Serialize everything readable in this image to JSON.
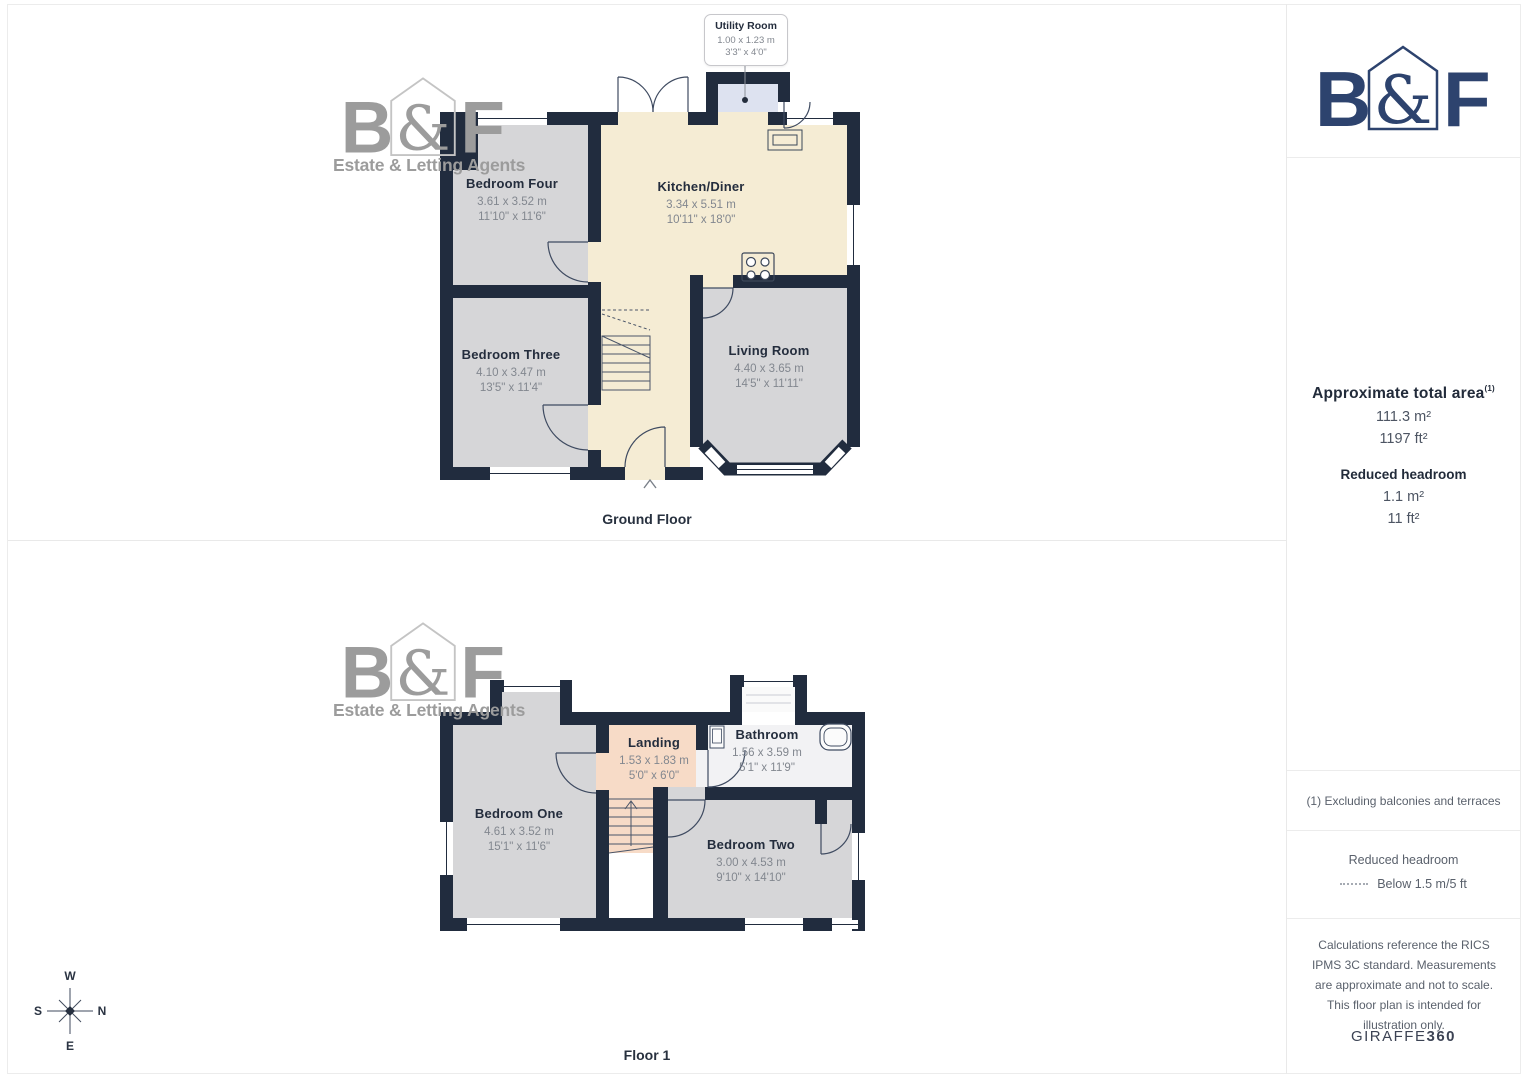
{
  "logo": {
    "letter_b": "B",
    "ampersand": "&",
    "letter_f": "F",
    "tagline": "Estate & Letting Agents",
    "navy": "#2d436e",
    "gray": "#9c9c9c"
  },
  "ground_floor": {
    "caption": "Ground Floor",
    "utility_callout": {
      "name": "Utility Room",
      "metric": "1.00 x 1.23 m",
      "imperial": "3'3\" x 4'0\""
    },
    "rooms": [
      {
        "name": "Bedroom Four",
        "metric": "3.61 x 3.52 m",
        "imperial": "11'10\" x 11'6\""
      },
      {
        "name": "Kitchen/Diner",
        "metric": "3.34 x 5.51 m",
        "imperial": "10'11\" x 18'0\""
      },
      {
        "name": "Bedroom Three",
        "metric": "4.10 x 3.47 m",
        "imperial": "13'5\" x 11'4\""
      },
      {
        "name": "Living Room",
        "metric": "4.40 x 3.65 m",
        "imperial": "14'5\" x 11'11\""
      }
    ]
  },
  "floor_1": {
    "caption": "Floor 1",
    "rooms": [
      {
        "name": "Bedroom One",
        "metric": "4.61 x 3.52 m",
        "imperial": "15'1\" x 11'6\""
      },
      {
        "name": "Landing",
        "metric": "1.53 x 1.83 m",
        "imperial": "5'0\" x 6'0\""
      },
      {
        "name": "Bathroom",
        "metric": "1.56 x 3.59 m",
        "imperial": "5'1\" x 11'9\""
      },
      {
        "name": "Bedroom Two",
        "metric": "3.00 x 4.53 m",
        "imperial": "9'10\" x 14'10\""
      }
    ]
  },
  "compass": {
    "north": "N",
    "south": "S",
    "east": "E",
    "west": "W"
  },
  "sidebar": {
    "area_title": "Approximate total area",
    "area_footnote_marker": "(1)",
    "area_m2": "111.3 m²",
    "area_ft2": "1197 ft²",
    "headroom_title": "Reduced headroom",
    "headroom_m2": "1.1 m²",
    "headroom_ft2": "11 ft²",
    "footnote": "(1) Excluding balconies and terraces",
    "legend_title": "Reduced headroom",
    "legend_label": "Below 1.5 m/5 ft",
    "disclaimer": "Calculations reference the RICS IPMS 3C standard. Measurements are approximate and not to scale. This floor plan is intended for illustration only.",
    "brand_name": "GIRAFFE",
    "brand_suffix": "360"
  }
}
